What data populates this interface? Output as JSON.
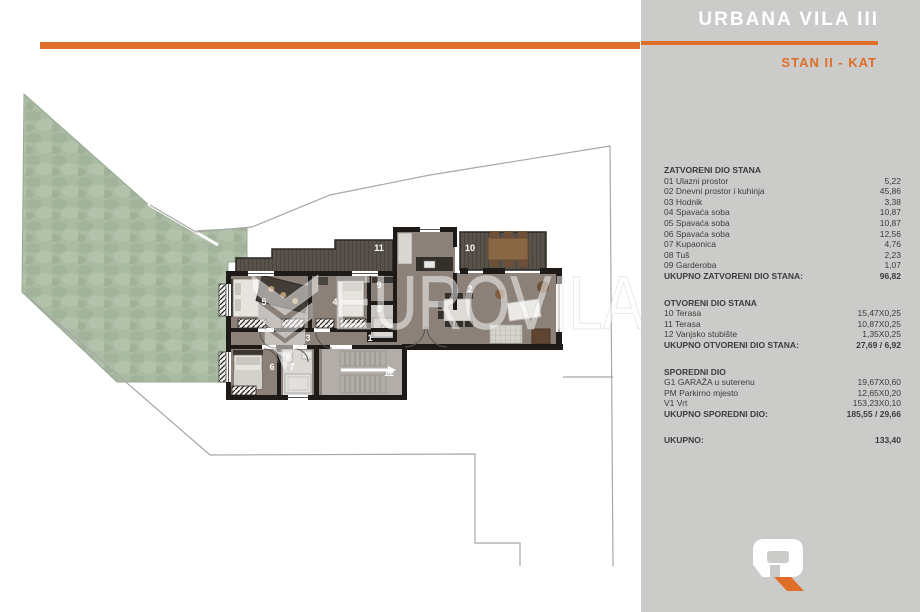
{
  "colors": {
    "accent": "#de6e28",
    "panel_bg": "#cbcbc9",
    "floor": "#8b8178",
    "wall": "#1d1a17",
    "deck": "#59524b",
    "garden": "#aabba3",
    "bath_floor": "#d6d3cf",
    "stairs_floor": "#b2ada8"
  },
  "panel": {
    "title": "URBANA VILA III",
    "subtitle": "STAN II - KAT",
    "sections": [
      {
        "header": "ZATVORENI DIO STANA",
        "rows": [
          {
            "label": "01 Ulazni prostor",
            "value": "5,22"
          },
          {
            "label": "02 Dnevni prostor i kuhinja",
            "value": "45,86"
          },
          {
            "label": "03 Hodnik",
            "value": "3,38"
          },
          {
            "label": "04 Spavaća soba",
            "value": "10,87"
          },
          {
            "label": "05 Spavaća soba",
            "value": "10,87"
          },
          {
            "label": "06 Spavaća soba",
            "value": "12,56"
          },
          {
            "label": "07 Kupaonica",
            "value": "4,76"
          },
          {
            "label": "08 Tuš",
            "value": "2,23"
          },
          {
            "label": "09 Garderoba",
            "value": "1,07"
          }
        ],
        "total": {
          "label": "UKUPNO ZATVORENI DIO STANA:",
          "value": "96,82"
        }
      },
      {
        "header": "OTVORENI DIO STANA",
        "rows": [
          {
            "label": "10 Terasa",
            "value": "15,47X0,25"
          },
          {
            "label": "11 Terasa",
            "value": "10,87X0,25"
          },
          {
            "label": "12 Vanjsko stubište",
            "value": "1,35X0,25"
          }
        ],
        "total": {
          "label": "UKUPNO OTVORENI DIO STANA:",
          "value": "27,69 / 6,92"
        }
      },
      {
        "header": "SPOREDNI DIO",
        "rows": [
          {
            "label": "G1 GARAŽA u suterenu",
            "value": "19,67X0,60"
          },
          {
            "label": "PM Parkirno mjesto",
            "value": "12,65X0,20"
          },
          {
            "label": "V1 Vrt",
            "value": "153,23X0,10"
          }
        ],
        "total": {
          "label": "UKUPNO SPOREDNI DIO:",
          "value": "185,55 / 29,66"
        }
      }
    ],
    "grand_total": {
      "label": "UKUPNO:",
      "value": "133,40"
    }
  },
  "plan": {
    "watermark": "EUROVILA",
    "room_labels": [
      {
        "text": "1"
      },
      {
        "text": "2"
      },
      {
        "text": "3"
      },
      {
        "text": "4"
      },
      {
        "text": "5"
      },
      {
        "text": "6"
      },
      {
        "text": "7"
      },
      {
        "text": "8"
      },
      {
        "text": "9"
      },
      {
        "text": "10"
      },
      {
        "text": "11"
      },
      {
        "text": "12"
      }
    ]
  }
}
